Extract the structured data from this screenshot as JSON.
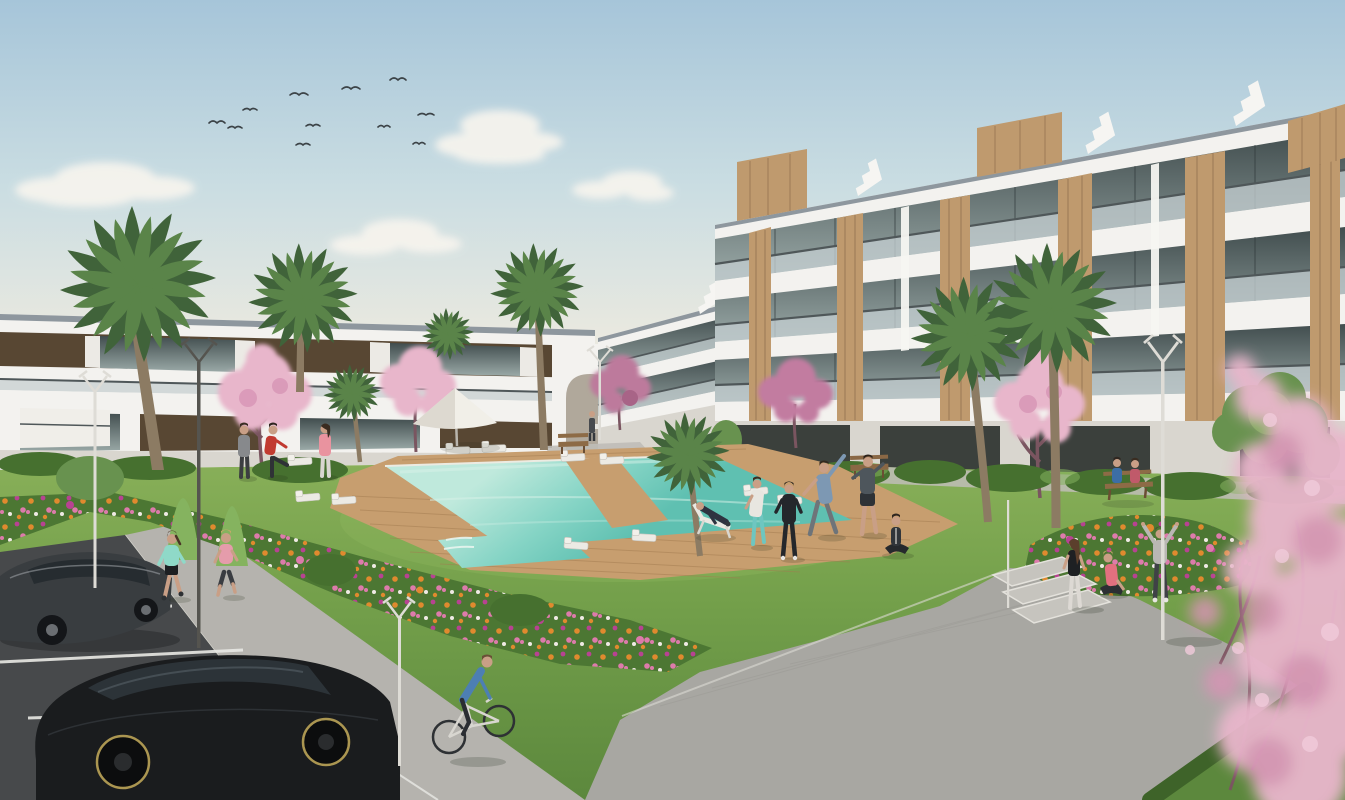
{
  "scene": {
    "type": "architectural-rendering",
    "alt": "Sunny 3D rendering of a modern white apartment complex with wood accents, turquoise swimming pool with wooden sun deck and loungers on a lawn, flower beds, palm and cherry-blossom trees, people jogging, cycling and exercising, and a parking lot with two dark cars.",
    "sky": {
      "bird_count": 11,
      "cloud_count": 4
    },
    "buildings": [
      {
        "id": "left-block",
        "floors": 2,
        "style": "white with dark wood window panels"
      },
      {
        "id": "right-block",
        "floors": 4,
        "style": "white stepped terraces, glass railings, wood panels, rooftop wood volumes"
      }
    ],
    "amenities": [
      "swimming pool",
      "wooden sun deck",
      "sun loungers",
      "parasol",
      "benches",
      "street lamps",
      "plaza steps",
      "flower beds",
      "hedges",
      "parking lot"
    ],
    "vegetation": [
      "palm trees",
      "cherry blossom trees",
      "green trees",
      "flower bushes",
      "lawn"
    ],
    "vehicles": [
      {
        "id": "sedan",
        "type": "sedan",
        "color_key": "car_grey"
      },
      {
        "id": "hatchback",
        "type": "hatchback",
        "color_key": "car_black"
      },
      {
        "id": "bicycle",
        "type": "bicycle",
        "color_key": "bike_frame"
      }
    ],
    "people": [
      {
        "id": "jogger-mint",
        "activity": "jogging"
      },
      {
        "id": "jogger-pink",
        "activity": "jogging"
      },
      {
        "id": "cyclist",
        "activity": "cycling"
      },
      {
        "id": "man-red-shirt",
        "activity": "warming up by pool"
      },
      {
        "id": "man-grey",
        "activity": "standing"
      },
      {
        "id": "woman-pink",
        "activity": "standing"
      },
      {
        "id": "man-stretching",
        "activity": "side stretch"
      },
      {
        "id": "man-shorts",
        "activity": "stretching"
      },
      {
        "id": "woman-yoga",
        "activity": "seated yoga"
      },
      {
        "id": "woman-teal-leggings",
        "activity": "exercising"
      },
      {
        "id": "person-tracksuit",
        "activity": "exercising"
      },
      {
        "id": "man-deck-chair",
        "activity": "lounging"
      },
      {
        "id": "woman-plaza",
        "activity": "standing"
      },
      {
        "id": "woman-sitting",
        "activity": "sitting on steps"
      },
      {
        "id": "person-hoodie",
        "activity": "arms raised"
      },
      {
        "id": "bench-couple",
        "activity": "sitting on bench"
      },
      {
        "id": "person-distant",
        "activity": "walking"
      }
    ]
  },
  "colors": {
    "sky_top": "#a6c5d9",
    "sky_mid": "#cadde2",
    "sky_horizon": "#eae9e0",
    "cloud": "#f7f4ee",
    "bird": "#3c4347",
    "building_white": "#f3f2ef",
    "building_shade": "#d9d6cf",
    "slab_edge": "#8e979e",
    "window_dark": "#414d4e",
    "window_light": "#9aa9a7",
    "rail_glass": "#c3cdcf",
    "rail_dark": "#4f5759",
    "wood": "#bf9a6e",
    "wood_dark": "#8b6b4b",
    "panel_dark": "#584733",
    "arch_inner": "#b0a89b",
    "grass_light": "#8db35c",
    "grass": "#74a04b",
    "grass_dark": "#5c883d",
    "hedge": "#46702f",
    "tree_green": "#68924f",
    "tree_green_light": "#85b35f",
    "palm_green": "#5a8449",
    "palm_dark": "#40633a",
    "trunk": "#8c7b63",
    "blossom": "#e8b6cb",
    "blossom_deep": "#d795b5",
    "blossom_light": "#f1cbdb",
    "blossom_mauve": "#bd7a9c",
    "branch": "#7a5560",
    "pool_far": "#bfe9dc",
    "pool_mid": "#85d4c5",
    "pool_near": "#5fc0b1",
    "coping": "#ecebe2",
    "deck": "#c79e6f",
    "deck_dark": "#a37c50",
    "path": "#a8a7a2",
    "path_light": "#bfbdb7",
    "sidewalk": "#b5b3ae",
    "plaza_light": "#c6c4be",
    "asphalt": "#47494b",
    "road_line": "#e9e9e5",
    "flower_green": "#4c7733",
    "flower_orange": "#e08a2e",
    "flower_pink": "#dd7bab",
    "flower_magenta": "#b84292",
    "flower_white": "#efeae4",
    "car_grey": "#393d40",
    "car_black": "#1a1c1e",
    "car_glass": "#262c30",
    "rim_gold": "#ab9651",
    "bike_frame": "#d8d6d0",
    "skin": "#c99f86",
    "lamp_white": "#dedcd6",
    "lamp_dark": "#55544f",
    "shirt_mint": "#8fd9c8",
    "shirt_pink": "#e59cab",
    "shirt_red": "#c13a31",
    "shirt_blue": "#4d7fb3",
    "teal_leggings": "#6ec6c0",
    "hoodie_grey": "#b9b7b3",
    "shadow": "#1f2a18"
  }
}
